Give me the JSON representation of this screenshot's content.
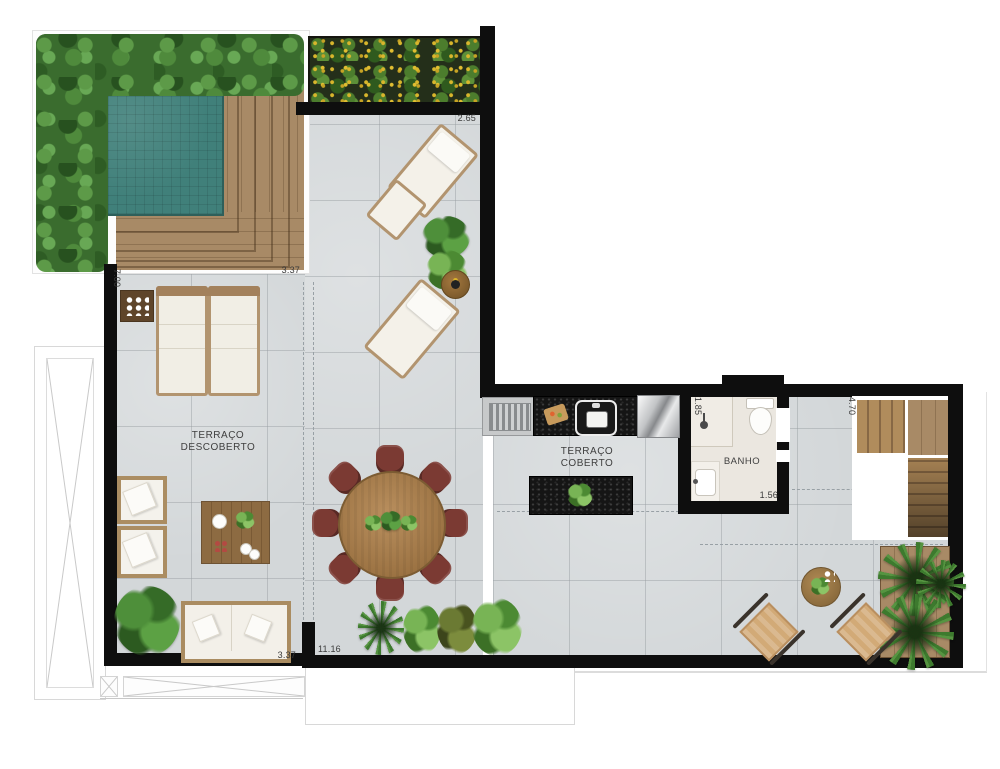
{
  "rooms": {
    "uncovered": {
      "line1": "TERRAÇO",
      "line2": "DESCOBERTO"
    },
    "covered": {
      "line1": "TERRAÇO",
      "line2": "COBERTO"
    },
    "bath": {
      "label": "BANHO"
    }
  },
  "dimensions": {
    "planter_width": "2.65",
    "deck_width": "3.37",
    "garden_side": "7.00",
    "bath_width": "1.85",
    "bath_door_side": "1.56",
    "stairs_side": "4.70",
    "sofa_wall_width": "3.37",
    "terrace_width": "11.16"
  },
  "palette": {
    "floor_tile": "#d3d7d9",
    "wall": "#0e0e0e",
    "pool_water": "#40807a",
    "deck_wood": "#a0835f",
    "hedge_green": "#3a6c2e",
    "planter_flowers_yellow": "#d9b62c",
    "granite_counter": "#151515",
    "dining_chair_red": "#7b3a33",
    "cushion_white": "#f3f0e9",
    "stair_wood": "#a98a5c",
    "bathroom_floor": "#ebe7e0",
    "outdoor_chair_tan": "#d2aa77"
  }
}
